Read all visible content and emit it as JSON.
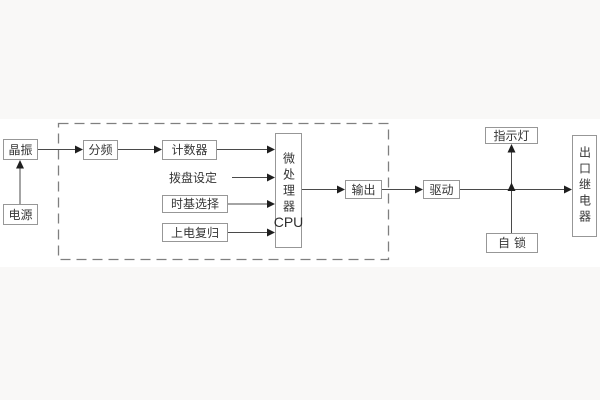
{
  "diagram": {
    "type": "block-diagram",
    "colors": {
      "background": "#f9f8f7",
      "panel": "#ffffff",
      "box_border": "#979797",
      "line": "#4a4a4a",
      "arrowhead": "#1f1f1f",
      "dashed_boundary": "#7f7f7f",
      "text": "#363636"
    },
    "nodes": {
      "crystal": {
        "label": "晶振"
      },
      "power": {
        "label": "电源"
      },
      "divider": {
        "label": "分频"
      },
      "counter": {
        "label": "计数器"
      },
      "dial_setting": {
        "label": "拨盘设定"
      },
      "timebase_select": {
        "label": "时基选择"
      },
      "power_on_reset": {
        "label": "上电复归"
      },
      "mcu": {
        "label": "微处理器",
        "sub_label": "CPU"
      },
      "output": {
        "label": "输出"
      },
      "drive": {
        "label": "驱动"
      },
      "indicator_lamp": {
        "label": "指示灯"
      },
      "self_lock": {
        "label": "自锁"
      },
      "outlet_relay": {
        "label": "出口继电器"
      }
    },
    "dashed_group_members": [
      "分频",
      "计数器",
      "拨盘设定",
      "时基选择",
      "上电复归",
      "微处理器CPU",
      "输出"
    ],
    "connections": [
      {
        "from": "power",
        "to": "crystal",
        "direction": "up"
      },
      {
        "from": "crystal",
        "to": "divider",
        "direction": "right"
      },
      {
        "from": "divider",
        "to": "counter",
        "direction": "right"
      },
      {
        "from": "counter",
        "to": "mcu",
        "direction": "right"
      },
      {
        "from": "dial_setting",
        "to": "mcu",
        "direction": "right"
      },
      {
        "from": "timebase_select",
        "to": "mcu",
        "direction": "right"
      },
      {
        "from": "power_on_reset",
        "to": "mcu",
        "direction": "right"
      },
      {
        "from": "mcu",
        "to": "output",
        "direction": "right"
      },
      {
        "from": "output",
        "to": "drive",
        "direction": "right"
      },
      {
        "from": "drive",
        "to": "outlet_relay",
        "direction": "right"
      },
      {
        "from": "junction",
        "to": "indicator_lamp",
        "direction": "up"
      },
      {
        "from": "self_lock",
        "to": "junction",
        "direction": "up"
      }
    ]
  }
}
